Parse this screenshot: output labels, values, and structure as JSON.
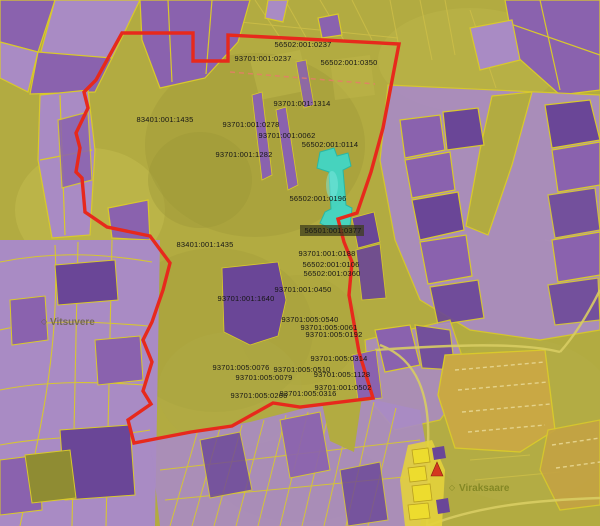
{
  "map": {
    "type": "cadastral-parcel-map",
    "colors": {
      "base_olive": "#b2ab41",
      "olive_dark": "#9c9636",
      "olive_bright": "#c3bb4e",
      "purple_light": "#a98bc4",
      "purple_mid": "#8a62ae",
      "purple_dark": "#6a4697",
      "parcel_line": "#d9c92b",
      "boundary_red": "#e7291c",
      "highlight_cyan": "#3ed8ca",
      "tan_field": "#c9a844",
      "village_yellow": "#e3d23c",
      "label_black": "#161616"
    },
    "icons": {
      "place_marker": "◇",
      "landmark_triangle": "landmark-triangle-icon"
    },
    "parcel_labels": [
      {
        "text": "56502:001:0237",
        "x": 303,
        "y": 47
      },
      {
        "text": "93701:001:0237",
        "x": 263,
        "y": 61
      },
      {
        "text": "56502:001:0350",
        "x": 349,
        "y": 65
      },
      {
        "text": "93701:001:1314",
        "x": 302,
        "y": 106
      },
      {
        "text": "83401:001:1435",
        "x": 165,
        "y": 122
      },
      {
        "text": "93701:001:0278",
        "x": 251,
        "y": 127
      },
      {
        "text": "93701:001:0062",
        "x": 287,
        "y": 138
      },
      {
        "text": "56502:001:0114",
        "x": 330,
        "y": 147
      },
      {
        "text": "93701:001:1282",
        "x": 244,
        "y": 157
      },
      {
        "text": "56502:001:0196",
        "x": 318,
        "y": 201
      },
      {
        "text": "56501:001:0377",
        "x": 333,
        "y": 233
      },
      {
        "text": "93701:001:0188",
        "x": 327,
        "y": 256
      },
      {
        "text": "56502:001:0106",
        "x": 331,
        "y": 267
      },
      {
        "text": "56502:001:0360",
        "x": 332,
        "y": 276
      },
      {
        "text": "83401:001:1435",
        "x": 205,
        "y": 247
      },
      {
        "text": "93701:001:0450",
        "x": 303,
        "y": 292
      },
      {
        "text": "93701:001:1640",
        "x": 246,
        "y": 301
      },
      {
        "text": "93701:005:0540",
        "x": 310,
        "y": 322
      },
      {
        "text": "93701:005:0061",
        "x": 329,
        "y": 330
      },
      {
        "text": "93701:005:0192",
        "x": 334,
        "y": 337
      },
      {
        "text": "93701:005:0314",
        "x": 339,
        "y": 361
      },
      {
        "text": "93701:005:0076",
        "x": 241,
        "y": 370
      },
      {
        "text": "93701:005:0510",
        "x": 302,
        "y": 372
      },
      {
        "text": "93701:005:1128",
        "x": 342,
        "y": 377
      },
      {
        "text": "93701:005:0079",
        "x": 264,
        "y": 380
      },
      {
        "text": "93701:001:0502",
        "x": 343,
        "y": 390
      },
      {
        "text": "93701:005:0266",
        "x": 259,
        "y": 398
      },
      {
        "text": "93701:005:0316",
        "x": 308,
        "y": 396
      }
    ],
    "place_labels": [
      {
        "text": "Vitsuvere",
        "x": 50,
        "y": 325,
        "mx": 44,
        "my": 324,
        "color": "#6b6247"
      },
      {
        "text": "Viraksaare",
        "x": 459,
        "y": 491,
        "mx": 452,
        "my": 490,
        "color": "#7c8220"
      }
    ]
  }
}
